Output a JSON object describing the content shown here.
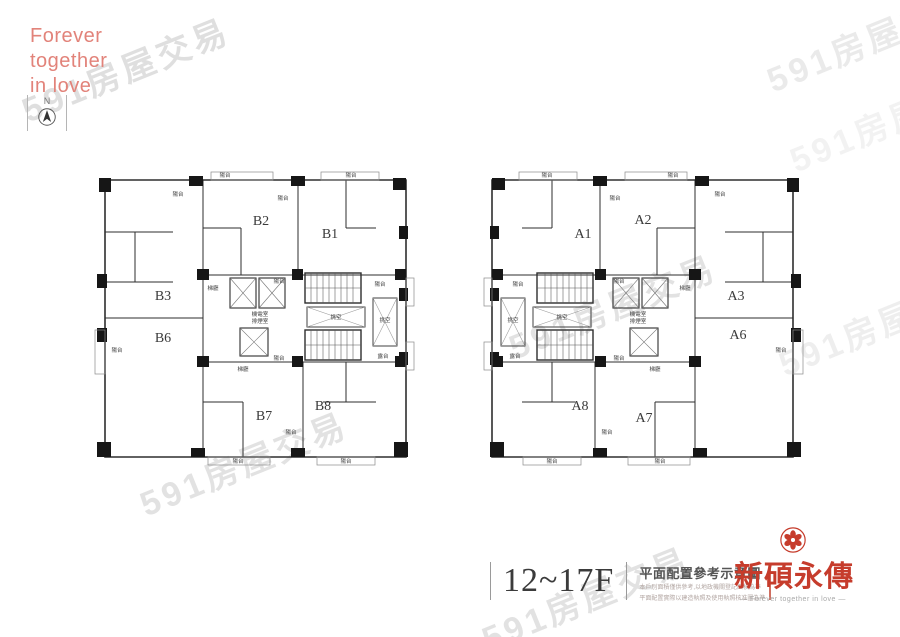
{
  "branding": {
    "lines": [
      "Forever",
      "together",
      "in love"
    ],
    "color": "#e2837a"
  },
  "compass": {
    "label": "N"
  },
  "watermark": {
    "text": "591房屋交易",
    "color": "#c6c6c6",
    "instances": [
      {
        "x": 125,
        "y": 68,
        "o": 0.55
      },
      {
        "x": 870,
        "y": 38,
        "o": 0.35
      },
      {
        "x": 893,
        "y": 118,
        "o": 0.22
      },
      {
        "x": 612,
        "y": 305,
        "o": 0.5
      },
      {
        "x": 243,
        "y": 462,
        "o": 0.5
      },
      {
        "x": 585,
        "y": 597,
        "o": 0.5
      },
      {
        "x": 882,
        "y": 322,
        "o": 0.28
      }
    ]
  },
  "plans": {
    "left": {
      "units": [
        {
          "label": "B2",
          "x": 168,
          "y": 55
        },
        {
          "label": "B1",
          "x": 237,
          "y": 68
        },
        {
          "label": "B3",
          "x": 70,
          "y": 130
        },
        {
          "label": "B6",
          "x": 70,
          "y": 172
        },
        {
          "label": "B7",
          "x": 171,
          "y": 250
        },
        {
          "label": "B8",
          "x": 230,
          "y": 240
        }
      ],
      "annotations": [
        {
          "t": "陽台",
          "x": 132,
          "y": 7
        },
        {
          "t": "陽台",
          "x": 258,
          "y": 7
        },
        {
          "t": "陽台",
          "x": 85,
          "y": 26
        },
        {
          "t": "陽台",
          "x": 190,
          "y": 30
        },
        {
          "t": "梯廳",
          "x": 120,
          "y": 120
        },
        {
          "t": "機電室",
          "x": 167,
          "y": 146
        },
        {
          "t": "排煙室",
          "x": 167,
          "y": 153
        },
        {
          "t": "梯廳",
          "x": 150,
          "y": 201
        },
        {
          "t": "挑空",
          "x": 243,
          "y": 149
        },
        {
          "t": "挑空",
          "x": 292,
          "y": 152
        },
        {
          "t": "陽台",
          "x": 186,
          "y": 113
        },
        {
          "t": "陽台",
          "x": 287,
          "y": 116
        },
        {
          "t": "陽台",
          "x": 186,
          "y": 190
        },
        {
          "t": "露台",
          "x": 290,
          "y": 188
        },
        {
          "t": "陽台",
          "x": 198,
          "y": 264
        },
        {
          "t": "陽台",
          "x": 24,
          "y": 182
        },
        {
          "t": "陽台",
          "x": 145,
          "y": 293
        },
        {
          "t": "陽台",
          "x": 253,
          "y": 293
        }
      ]
    },
    "right": {
      "units": [
        {
          "label": "A1",
          "x": 105,
          "y": 68
        },
        {
          "label": "A2",
          "x": 165,
          "y": 54
        },
        {
          "label": "A3",
          "x": 258,
          "y": 130
        },
        {
          "label": "A6",
          "x": 260,
          "y": 169
        },
        {
          "label": "A8",
          "x": 102,
          "y": 240
        },
        {
          "label": "A7",
          "x": 166,
          "y": 252
        }
      ],
      "annotations": [
        {
          "t": "陽台",
          "x": 195,
          "y": 7
        },
        {
          "t": "陽台",
          "x": 69,
          "y": 7
        },
        {
          "t": "陽台",
          "x": 242,
          "y": 26
        },
        {
          "t": "陽台",
          "x": 137,
          "y": 30
        },
        {
          "t": "梯廳",
          "x": 207,
          "y": 120
        },
        {
          "t": "機電室",
          "x": 160,
          "y": 146
        },
        {
          "t": "排煙室",
          "x": 160,
          "y": 153
        },
        {
          "t": "梯廳",
          "x": 177,
          "y": 201
        },
        {
          "t": "挑空",
          "x": 84,
          "y": 149
        },
        {
          "t": "挑空",
          "x": 35,
          "y": 152
        },
        {
          "t": "陽台",
          "x": 141,
          "y": 113
        },
        {
          "t": "陽台",
          "x": 40,
          "y": 116
        },
        {
          "t": "陽台",
          "x": 141,
          "y": 190
        },
        {
          "t": "露台",
          "x": 37,
          "y": 188
        },
        {
          "t": "陽台",
          "x": 129,
          "y": 264
        },
        {
          "t": "陽台",
          "x": 303,
          "y": 182
        },
        {
          "t": "陽台",
          "x": 182,
          "y": 293
        },
        {
          "t": "陽台",
          "x": 74,
          "y": 293
        }
      ]
    }
  },
  "footer": {
    "floor_range": "12~17F",
    "plan_title": "平面配置參考示意圖",
    "disclaimers": [
      "本戶別面積僅供參考,以地政機關登記面積為準",
      "平面配置實際以建造執照及使用執照核准圖為準"
    ]
  },
  "logo": {
    "name": "新碩永傳",
    "tagline": "— Forever together in love —",
    "color": "#c63c2c"
  }
}
